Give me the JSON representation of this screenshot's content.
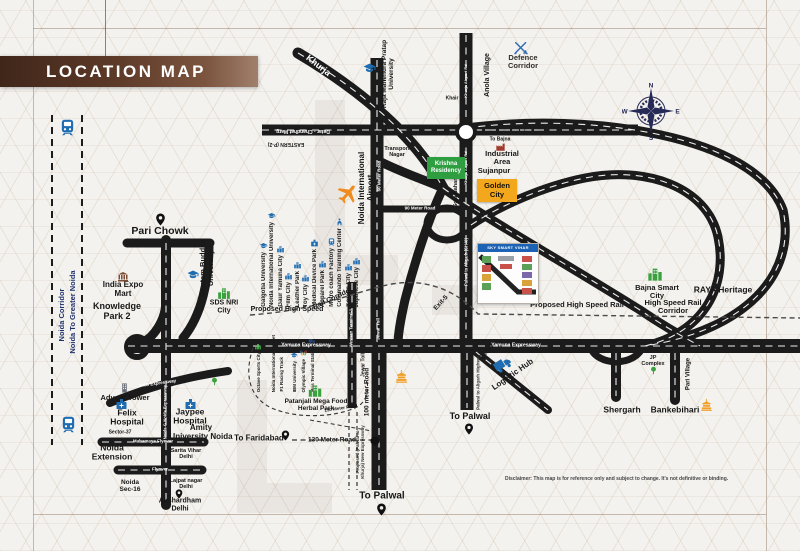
{
  "palette": {
    "banner_brown": "#5d3a28",
    "krishna_green": "#2e9e41",
    "golden_orange": "#f2a71d",
    "corridor_navy": "#20306b",
    "icon_blue": "#1f6cb0",
    "road_black": "#1b1b1b"
  },
  "header": {
    "title": "LOCATION MAP"
  },
  "corridor": {
    "line1": "Noida Corridor",
    "line2": "Noida To Greater Noida"
  },
  "compass": {
    "n": "N",
    "e": "E",
    "s": "S",
    "w": "W"
  },
  "labels": {
    "pari_chowk": "Pari Chowk",
    "india_expo_mart": "India Expo\nMart",
    "knowledge_park": "Knowledge\nPark 2",
    "gautam_buddha_university": "Gautam Buddha\nUniversity",
    "sds_nri_city": "SDS NRI\nCity",
    "khurja": "Khurja",
    "raja_mahendra_pratap": "Raja Mahendra Pratap\nUniversity",
    "anola_village": "Anola Village",
    "khair": "Khair",
    "defence_corridor": "Defence\nCorridor",
    "transport_nagar": "Transport\nNagar",
    "krishna_residency": "Krishna\nResidency",
    "industrial_area": "Industrial\nArea",
    "sujanpur": "Sujanpur",
    "golden_city": "Golden\nCity",
    "sola_nahar": "Sola Nahar",
    "inset_title": "SKY SMART VIHAR",
    "noida_intl_airport": "Noida International\nAirport",
    "bajna_smart_city": "Bajna Smart\nCity",
    "raya_heritage": "RAYA Heritage",
    "high_speed_rail_corridor": "High Speed Rail\nCorridor",
    "logistic_hub": "Logistic Hub",
    "to_palwal": "To Palwal",
    "shergarh": "Shergarh",
    "jp_complex": "JP\nComplex",
    "bankebihari": "Bankebihari",
    "pari_village": "Pari Village",
    "advant_tower": "Advant Tower",
    "felix_hospital": "Felix\nHospital",
    "jaypee_hospital": "Jaypee\nHospital",
    "amity_university": "Amity\nUniversity Noida",
    "sector_37": "Sector-37",
    "noida_extension": "Noida\nExtension",
    "sarita_vihar": "Sarita Vihar\nDelhi",
    "noida_sec16": "Noida\nSec-16",
    "lajpat_nagar": "Lajpat nagar\nDelhi",
    "akshardham": "Akshardham\nDelhi",
    "to_faridabad": "To Faridabad",
    "patanjali": "Patanjali Mega Food\nHerbal Park"
  },
  "roads": {
    "datar_chandhat_marg": "Datar - Chandhat Marg",
    "eastern_p2": "EASTERN (P-2)",
    "to_bajna": "To Bajna",
    "meter_90": "90 Meter Road",
    "khurja_airport_rd": "Khurja Airport Rd",
    "palwal_to_aligarh_sh40": "Palwal to Aligarh (SH40)",
    "proposed_hsr_1": "Proposed High Speed",
    "proposed_hsr_2": "Rail Corridor",
    "proposed_hsr": "Proposed High Speed Rail",
    "yamuna_expressway": "Yamuna Expressway",
    "exit_5": "Exit-5",
    "exit_9": "Exit-9",
    "jewar_toll": "Jewar Toll",
    "meter_100": "100 meter Road",
    "meter_60": "60 Meter Road",
    "palwal_to_aligarh_highway": "Palwal to Aligarh Highway",
    "mahamaya_flyover": "Mahamaya Flyover",
    "flyover": "Flyover",
    "fng_expressway": "FNG Expressway",
    "noida_gnoida_expressway": "Noida-G Noida Expressway",
    "meter_130": "130 Meter Road",
    "proposed_palwal_khurja": "Proposed (Palwal to\nKhurja) New Expressway",
    "western_terminal": "Western Terminal-1"
  },
  "cluster_industrial": [
    "Galgotia University",
    "Noida International University",
    "Gaur Yamuna City",
    "Film City",
    "Leather Park",
    "Toy City",
    "Medical Device Park",
    "Apparel Park",
    "Metro coach Factory",
    "Commando Training Center",
    "Korean City",
    "Japanese City"
  ],
  "cluster_sports": [
    "Octave Sports City",
    "Noida International Cricket",
    "F1 Racing Track",
    "IBM University",
    "Olympic Village",
    "Bus Terminal Station"
  ],
  "footer": {
    "disclaimer": "Disclaimer: This map is for reference only and subject to change. It's not definitive or binding."
  }
}
